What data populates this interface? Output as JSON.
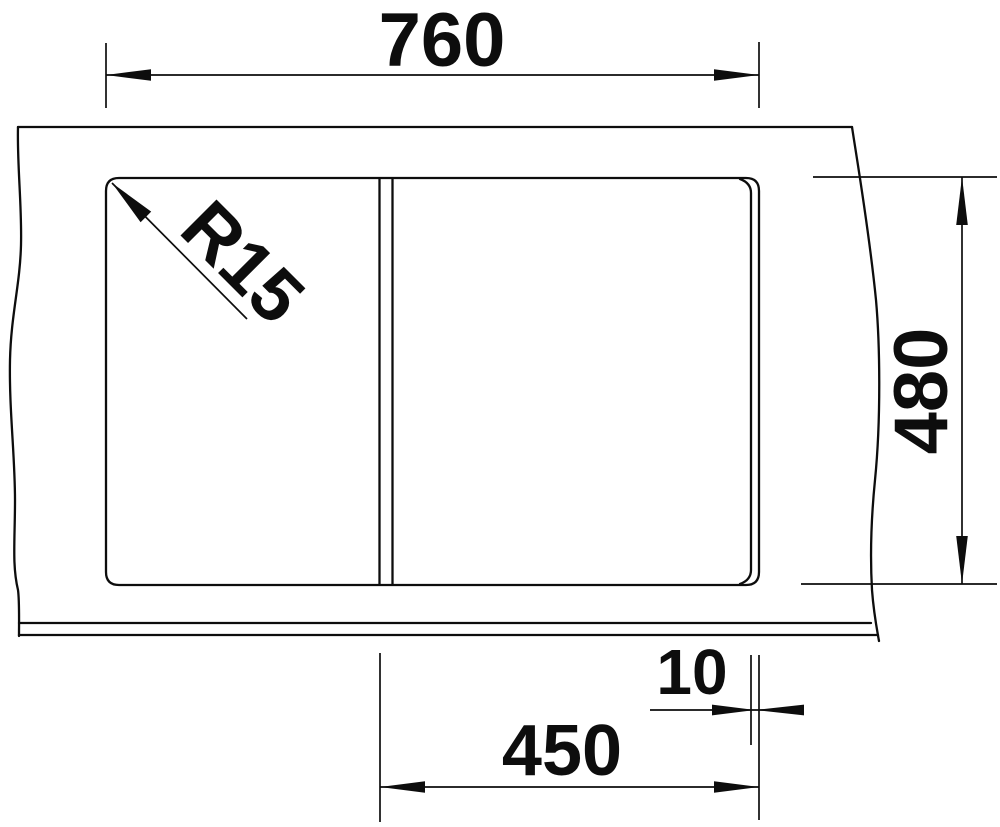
{
  "drawing": {
    "type": "sink-cutout-technical-drawing",
    "labels": {
      "overall_width": "760",
      "overall_depth": "480",
      "corner_radius": "R15",
      "rim_offset": "10",
      "bowl_width": "450"
    },
    "colors": {
      "line": "#0d0d0d",
      "background": "#ffffff"
    }
  }
}
